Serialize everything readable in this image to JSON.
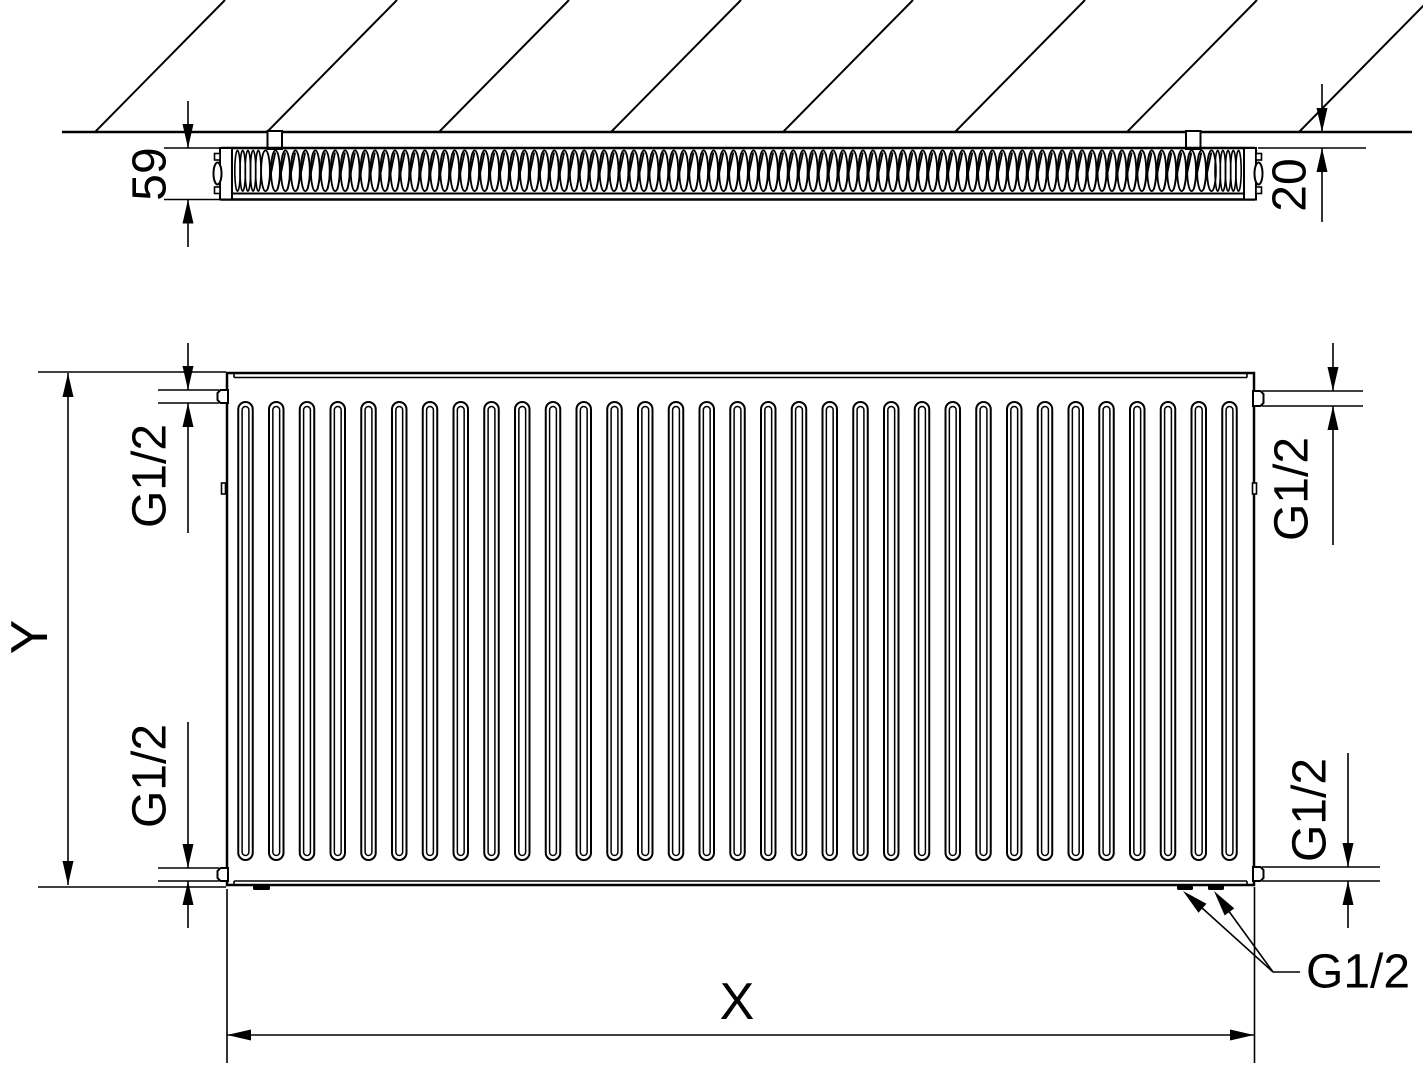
{
  "figure": {
    "type": "technical-drawing",
    "subject": "Panel radiator dimensional drawing: top cross-section view against wall and front view with G1/2 connections",
    "colors": {
      "line": "#000000",
      "background": "#ffffff"
    },
    "top_view": {
      "depth_label": "59",
      "wall_gap_label": "20",
      "wall_bracket_count": 2,
      "hatch_line_count": 8,
      "fin_loop_count": 96,
      "fin_end_loop_count": 5
    },
    "front_view": {
      "rib_count": 33,
      "height_label": "Y",
      "width_label": "X",
      "connections": {
        "top_left": "G1/2",
        "top_right": "G1/2",
        "bottom_left": "G1/2",
        "bottom_right": "G1/2",
        "bottom_pair_leader": "G1/2"
      }
    }
  }
}
